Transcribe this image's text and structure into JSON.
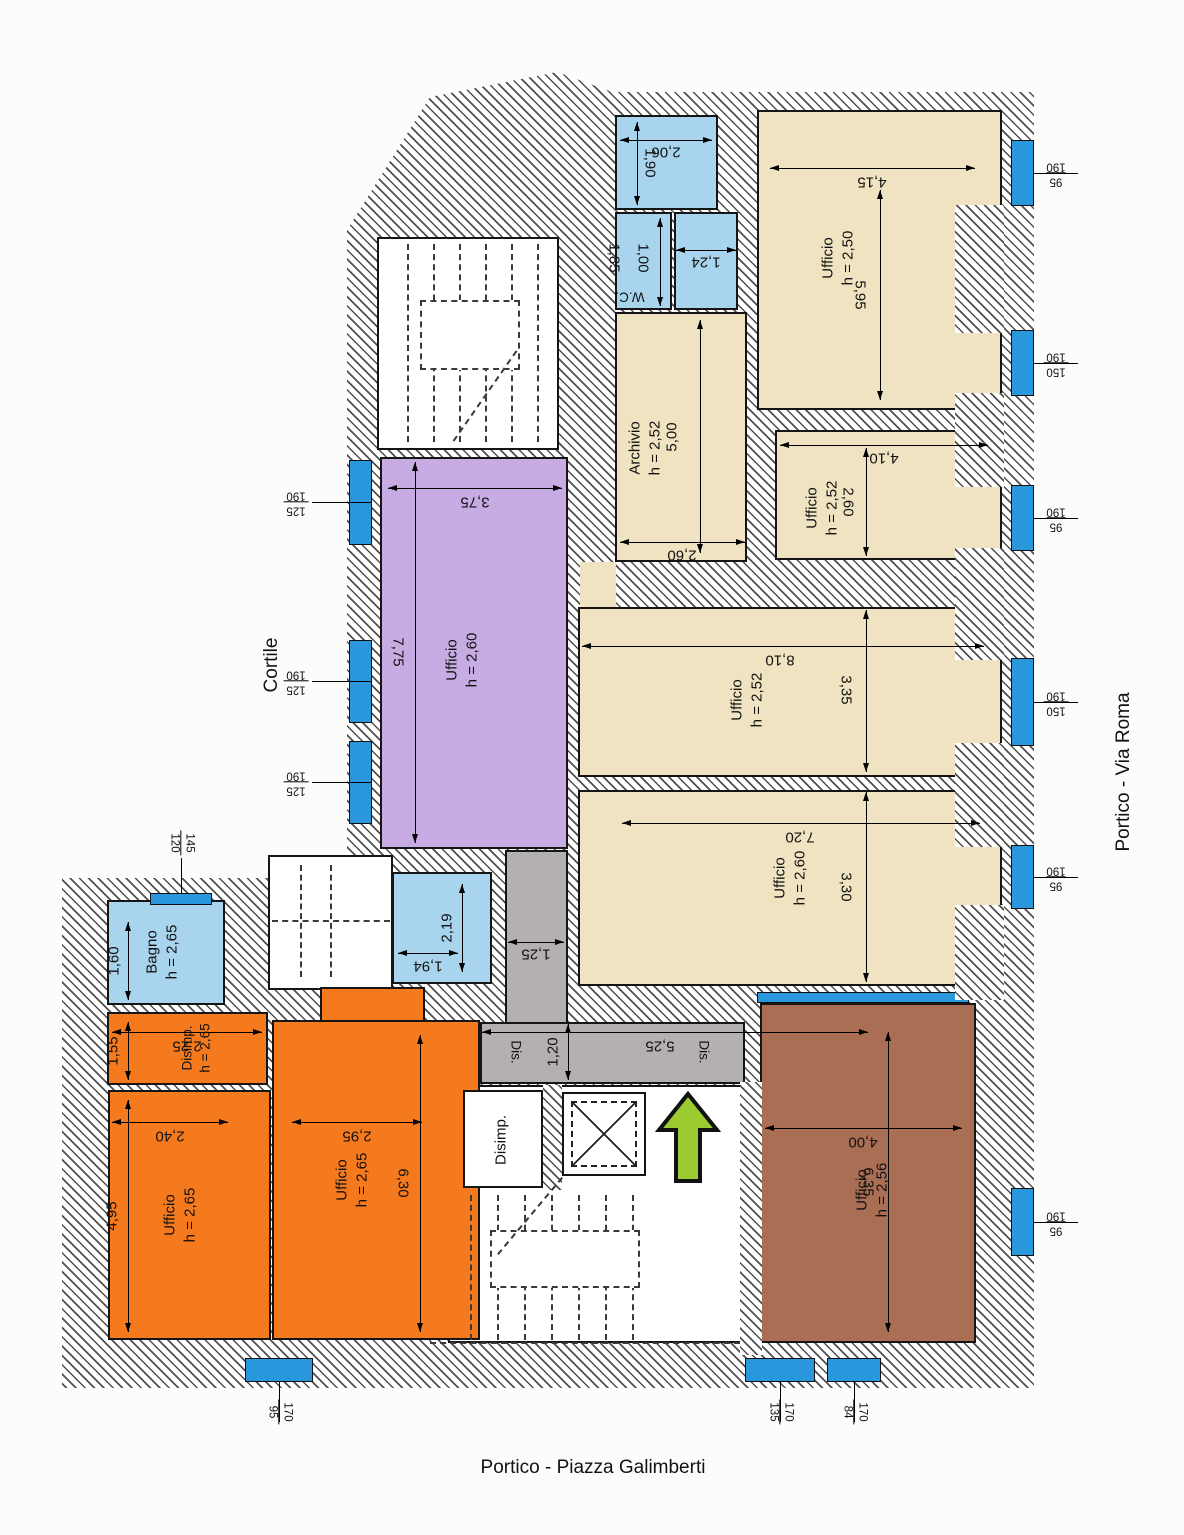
{
  "plan_title": "Floor plan - office level",
  "outside_labels": {
    "left": "Cortile",
    "right": "Portico - Via Roma",
    "bottom": "Portico - Piazza Galimberti"
  },
  "rooms": [
    {
      "label": "Ufficio",
      "h": "h = 2,50"
    },
    {
      "label": "Archivio",
      "h": "h = 2,52"
    },
    {
      "label": "Ufficio",
      "h": "h = 2,52"
    },
    {
      "label": "Ufficio",
      "h": "h = 2,52"
    },
    {
      "label": "Ufficio",
      "h": "h = 2,60"
    },
    {
      "label": "Ufficio",
      "h": "h = 2,60"
    },
    {
      "label": "Bagno",
      "h": "h = 2,65"
    },
    {
      "label": "Disimp.",
      "h": "h = 2,65"
    },
    {
      "label": "Ufficio",
      "h": "h = 2,65"
    },
    {
      "label": "Ufficio",
      "h": "h = 2,65"
    },
    {
      "label": "Ufficio",
      "h": "h = 2,56"
    },
    {
      "label": "W.C.",
      "h": ""
    },
    {
      "label": "Disimp.",
      "h": ""
    }
  ],
  "corridor": {
    "left": "Dis.",
    "right": "Dis."
  },
  "dims": {
    "d206": "2,06",
    "d190": "1,90",
    "d185": "1,85",
    "d100": "1,00",
    "d124": "1,24",
    "d415": "4,15",
    "d595": "5,95",
    "d500": "5,00",
    "d260a": "2,60",
    "d410": "4,10",
    "d260b": "2,60",
    "d810": "8,10",
    "d335": "3,35",
    "d720": "7,20",
    "d330": "3,30",
    "d375": "3,75",
    "d775": "7,75",
    "d160": "1,60",
    "d219": "2,19",
    "d194": "1,94",
    "d155": "1,55",
    "d225": "2,25",
    "d240": "2,40",
    "d495": "4,95",
    "d295": "2,95",
    "d630": "6,30",
    "d400": "4,00",
    "d635": "6,35",
    "d125": "1,25",
    "d120": "1,20",
    "d525": "5,25"
  },
  "windows": [
    {
      "n1": "190",
      "n2": "125"
    },
    {
      "n1": "190",
      "n2": "125"
    },
    {
      "n1": "190",
      "n2": "125"
    },
    {
      "n1": "120",
      "n2": "145"
    },
    {
      "n1": "190",
      "n2": "95"
    },
    {
      "n1": "190",
      "n2": "150"
    },
    {
      "n1": "190",
      "n2": "95"
    },
    {
      "n1": "190",
      "n2": "150"
    },
    {
      "n1": "190",
      "n2": "95"
    },
    {
      "n1": "190",
      "n2": "95"
    },
    {
      "n1": "95",
      "n2": "170"
    },
    {
      "n1": "135",
      "n2": "170"
    },
    {
      "n1": "84",
      "n2": "170"
    }
  ],
  "colors": {
    "office_beige": "#f0e3c2",
    "service_blue": "#a9d4ee",
    "office_purple": "#c6ace2",
    "office_orange": "#f5791d",
    "office_brown": "#aa6e54",
    "corridor_gray": "#b4b0b0",
    "window_blue": "#2a96dc",
    "entrance_arrow_green": "#9bcb30"
  }
}
